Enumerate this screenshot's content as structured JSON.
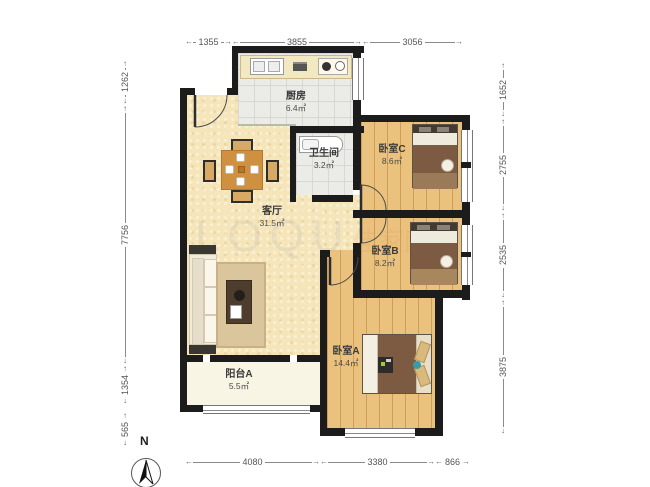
{
  "plan": {
    "rooms": {
      "kitchen": {
        "name": "厨房",
        "area": "6.4㎡"
      },
      "bathroom": {
        "name": "卫生间",
        "area": "3.2㎡"
      },
      "bedroom_c": {
        "name": "卧室C",
        "area": "8.6㎡"
      },
      "living": {
        "name": "客厅",
        "area": "31.5㎡"
      },
      "bedroom_b": {
        "name": "卧室B",
        "area": "8.2㎡"
      },
      "bedroom_a": {
        "name": "卧室A",
        "area": "14.4㎡"
      },
      "balcony": {
        "name": "阳台A",
        "area": "5.5㎡"
      }
    },
    "dimensions_mm": {
      "top": [
        "1355",
        "3855",
        "3056"
      ],
      "bottom": [
        "4080",
        "3380",
        "866"
      ],
      "left": [
        "1262",
        "7756",
        "1354",
        "565"
      ],
      "right": [
        "1652",
        "2755",
        "2535",
        "3875"
      ]
    },
    "compass": {
      "label": "N"
    },
    "watermark": {
      "latin": "LOQU",
      "cjk": "佳家网"
    },
    "colors": {
      "wall": "#1c1c1c",
      "wood_floor": "#eac17d",
      "living_floor": "#f5e5b9",
      "tile_floor": "#ebebe7",
      "balcony_floor": "#f8f5e4",
      "bed_blanket": "#7d5b42",
      "dim_text": "#555555"
    }
  }
}
